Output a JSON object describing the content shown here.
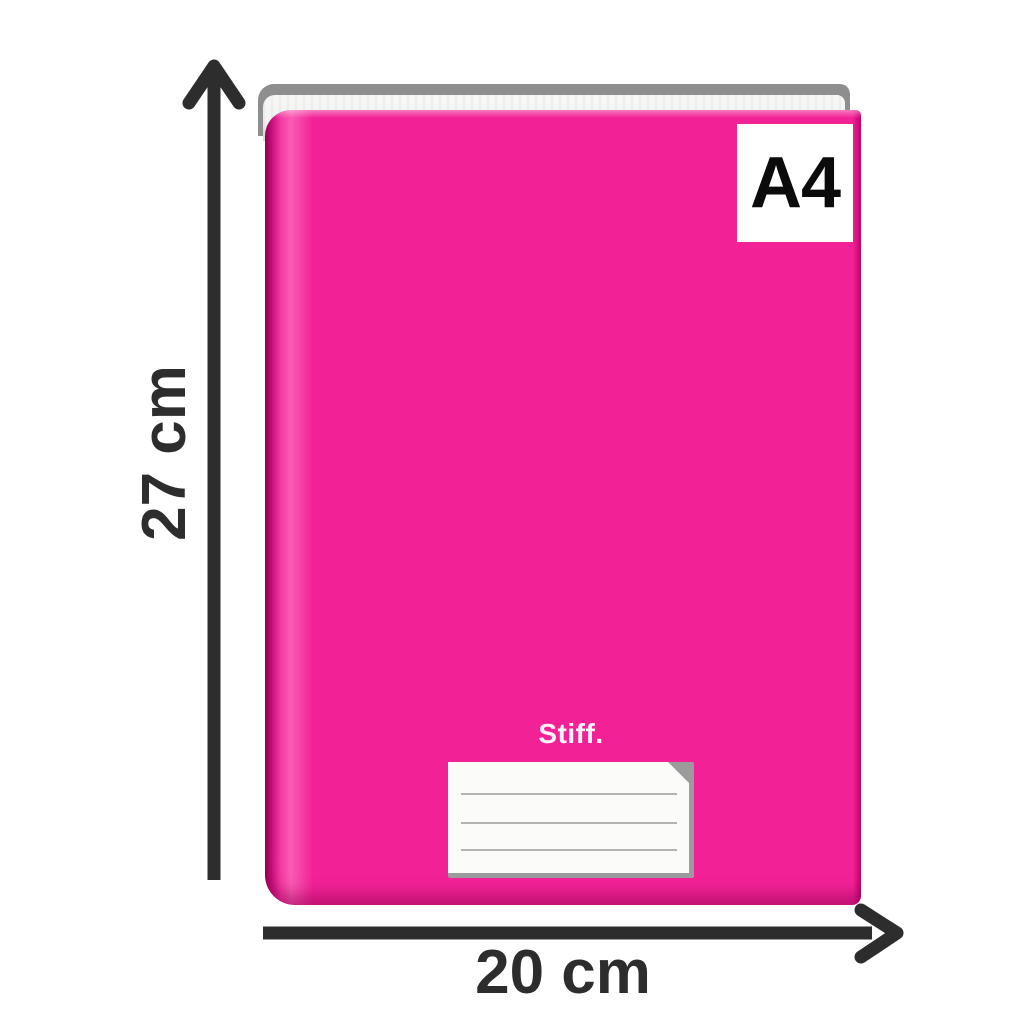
{
  "product": {
    "brand": "Stiff.",
    "size_label": "A4"
  },
  "dimensions": {
    "height_label": "27 cm",
    "width_label": "20 cm"
  },
  "name_plate": {
    "line_count": 3
  },
  "icons": {
    "height_arrow": "up-arrow",
    "width_arrow": "right-arrow"
  },
  "colors": {
    "background": "#FFFFFF",
    "cover_pink": "#F22296",
    "spine_shadow": "#8F0054",
    "cover_edge_dark": "#C4006E",
    "pages_white": "#F2F2F0",
    "back_cover_gray": "#8E8E8E",
    "annotation_dark": "#2D2D2D",
    "badge_bg": "#FFFFFF",
    "badge_text": "#0B0B0B",
    "plate_bg": "#FBFBFA",
    "plate_line_gray": "#9A9A9A",
    "plate_edge_gray": "#9B9B9B"
  }
}
